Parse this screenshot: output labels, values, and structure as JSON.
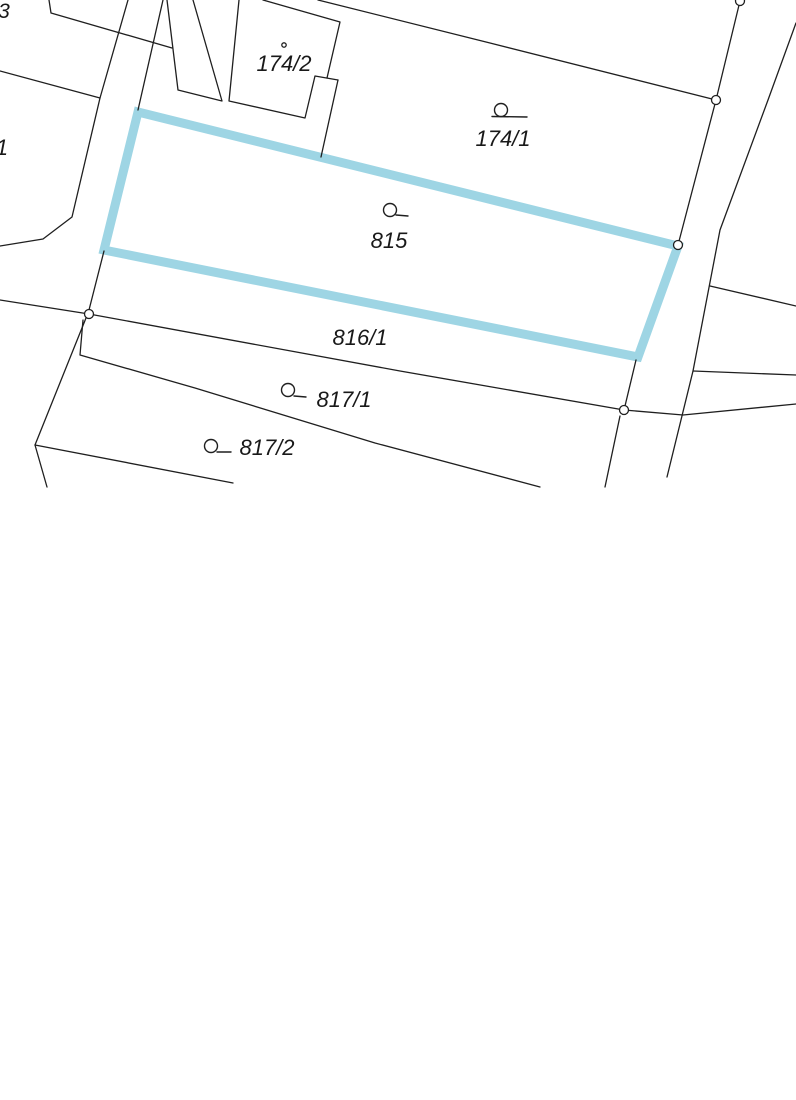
{
  "page": {
    "width": 796,
    "height": 1100,
    "background": "#ffffff"
  },
  "map": {
    "colors": {
      "boundary_line": "#1f1f1f",
      "highlight": "#9ed5e4",
      "label_text": "#191919",
      "marker_fill": "#ffffff"
    },
    "selected_parcel": {
      "id": "815",
      "outline": [
        [
          138,
          112
        ],
        [
          678,
          246
        ],
        [
          638,
          357
        ],
        [
          104,
          250
        ]
      ],
      "stroke_width": 9
    },
    "boundary_lines": [
      {
        "name": "strip-parcel-west",
        "points": [
          [
            167,
            0
          ],
          [
            178,
            90
          ],
          [
            222,
            101
          ],
          [
            193,
            0
          ]
        ]
      },
      {
        "name": "corner-top-left",
        "points": [
          [
            49,
            0
          ],
          [
            51,
            13
          ],
          [
            172,
            48
          ]
        ]
      },
      {
        "name": "west-boundary",
        "points": [
          [
            0,
            71
          ],
          [
            100,
            98
          ]
        ]
      },
      {
        "name": "road-west-upper",
        "points": [
          [
            128,
            0
          ],
          [
            100,
            98
          ],
          [
            72,
            217
          ],
          [
            43,
            239
          ],
          [
            0,
            246
          ]
        ]
      },
      {
        "name": "building-outline",
        "points": [
          [
            239,
            0
          ],
          [
            229,
            101
          ],
          [
            305,
            118
          ],
          [
            315,
            76
          ],
          [
            338,
            80
          ]
        ]
      },
      {
        "name": "building-right-edge",
        "points": [
          [
            327,
            78
          ],
          [
            340,
            22
          ],
          [
            263,
            0
          ]
        ]
      },
      {
        "name": "building-notch-boundary",
        "points": [
          [
            338,
            80
          ],
          [
            321,
            157
          ]
        ]
      },
      {
        "name": "parcel-174-1-north",
        "points": [
          [
            318,
            0
          ],
          [
            490,
            43
          ],
          [
            716,
            100
          ]
        ]
      },
      {
        "name": "road-east-upper",
        "points": [
          [
            163,
            0
          ],
          [
            138,
            110
          ]
        ]
      },
      {
        "name": "road-west",
        "points": [
          [
            740,
            1
          ],
          [
            716,
            100
          ],
          [
            678,
            245
          ]
        ]
      },
      {
        "name": "road-east",
        "points": [
          [
            796,
            23
          ],
          [
            768,
            100
          ],
          [
            720,
            230
          ],
          [
            693,
            371
          ],
          [
            667,
            477
          ]
        ]
      },
      {
        "name": "east-branch-upper",
        "points": [
          [
            710,
            286
          ],
          [
            796,
            306
          ]
        ]
      },
      {
        "name": "east-branch-lower",
        "points": [
          [
            693,
            371
          ],
          [
            796,
            375
          ]
        ]
      },
      {
        "name": "parcel-816-1-south",
        "points": [
          [
            0,
            300
          ],
          [
            89,
            314
          ],
          [
            400,
            371
          ],
          [
            624,
            410
          ],
          [
            683,
            415
          ],
          [
            796,
            404
          ]
        ]
      },
      {
        "name": "west-edge-upper",
        "points": [
          [
            104,
            251
          ],
          [
            89,
            310
          ]
        ]
      },
      {
        "name": "west-edge-lower",
        "points": [
          [
            86,
            318
          ],
          [
            35,
            445
          ],
          [
            47,
            487
          ]
        ]
      },
      {
        "name": "parcel-817-2-south",
        "points": [
          [
            35,
            445
          ],
          [
            233,
            483
          ]
        ]
      },
      {
        "name": "east-edge-cyan-to-node",
        "points": [
          [
            636,
            360
          ],
          [
            625,
            406
          ]
        ]
      },
      {
        "name": "east-vertical-south",
        "points": [
          [
            620,
            416
          ],
          [
            605,
            487
          ]
        ]
      },
      {
        "name": "parcel-817-1-south",
        "points": [
          [
            83,
            320
          ],
          [
            80,
            355
          ],
          [
            195,
            388
          ],
          [
            375,
            443
          ],
          [
            540,
            487
          ]
        ]
      }
    ],
    "vertex_markers": [
      [
        740,
        1
      ],
      [
        716,
        100
      ],
      [
        678,
        245
      ],
      [
        89,
        314
      ],
      [
        624,
        410
      ]
    ],
    "building_point": {
      "x": 284,
      "y": 45,
      "r": 2.2
    },
    "landuse_symbols": [
      {
        "parcel": "174/1",
        "circle": [
          501,
          110,
          6.5
        ],
        "tick": [
          492,
          116.5,
          527,
          117
        ]
      },
      {
        "parcel": "815",
        "circle": [
          390,
          210,
          6.5
        ],
        "tick": [
          396,
          215,
          408,
          216
        ]
      },
      {
        "parcel": "817/1",
        "circle": [
          288,
          390,
          6.5
        ],
        "tick": [
          294,
          396,
          306,
          397
        ]
      },
      {
        "parcel": "817/2",
        "circle": [
          211,
          446,
          6.5
        ],
        "tick": [
          217,
          452,
          231,
          452
        ]
      }
    ],
    "labels": [
      {
        "text": "3",
        "x": 4,
        "y": 18,
        "size": 21
      },
      {
        "text": "1",
        "x": 2,
        "y": 155,
        "size": 22
      },
      {
        "text": "174/2",
        "x": 284,
        "y": 71,
        "size": 22
      },
      {
        "text": "174/1",
        "x": 503,
        "y": 146,
        "size": 22
      },
      {
        "text": "815",
        "x": 389,
        "y": 248,
        "size": 22
      },
      {
        "text": "816/1",
        "x": 360,
        "y": 345,
        "size": 22
      },
      {
        "text": "817/1",
        "x": 344,
        "y": 407,
        "size": 22
      },
      {
        "text": "817/2",
        "x": 267,
        "y": 455,
        "size": 22
      }
    ]
  }
}
